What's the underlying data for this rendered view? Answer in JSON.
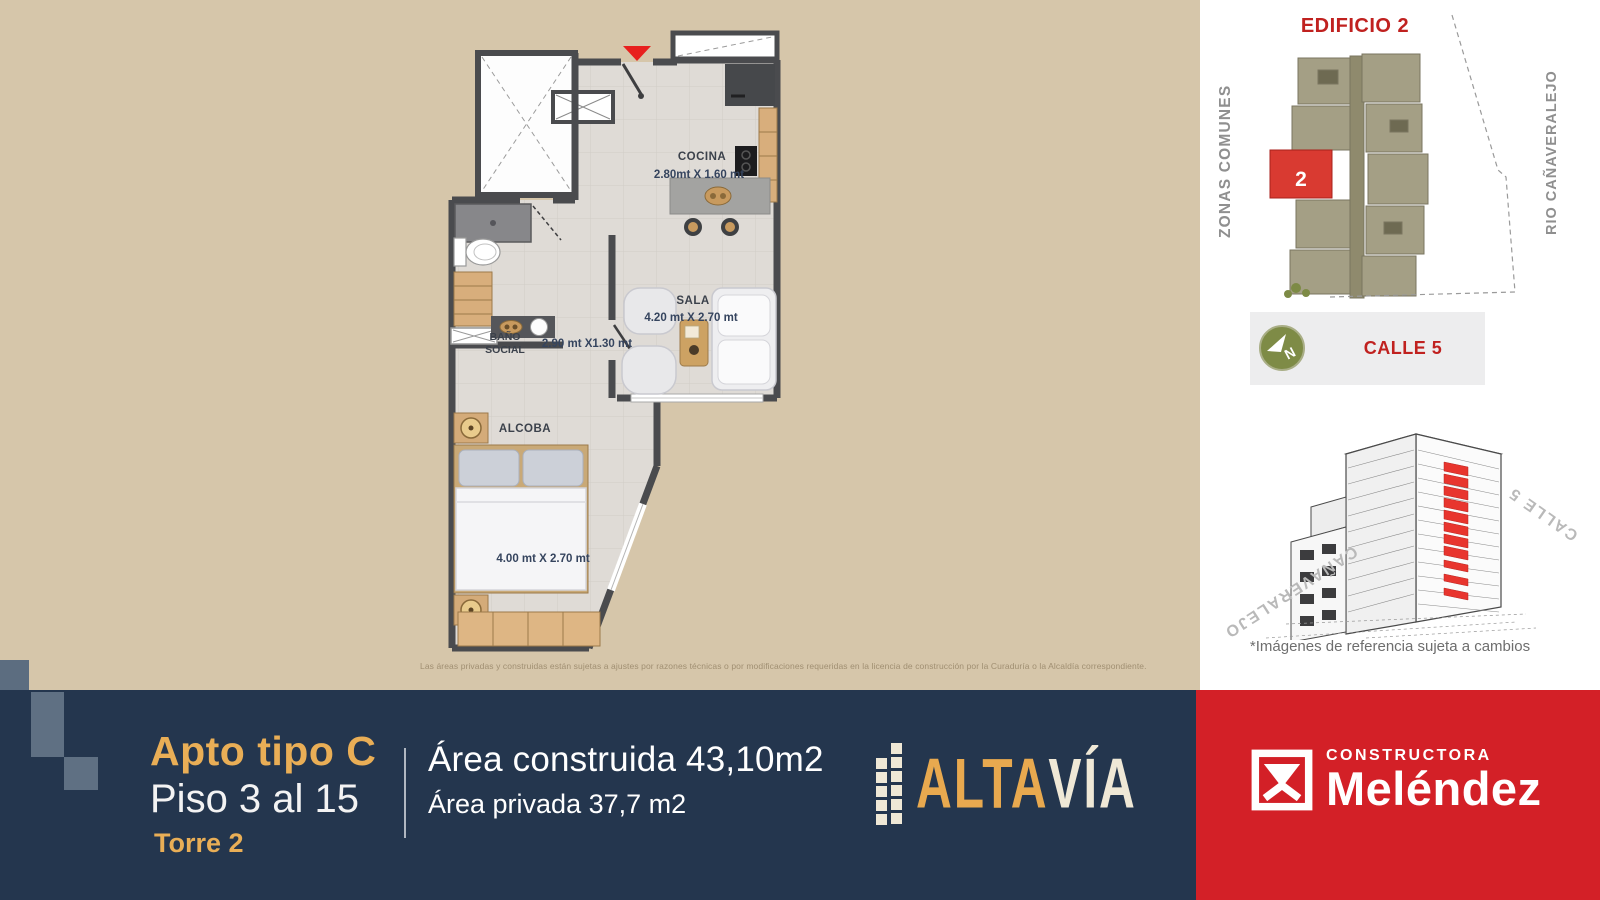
{
  "plan": {
    "rooms": {
      "cocina": {
        "name": "COCINA",
        "dims": "2.80mt X 1.60 mt"
      },
      "sala": {
        "name": "SALA",
        "dims": "4.20 mt X 2.70 mt"
      },
      "bano": {
        "line1": "BAÑO",
        "line2": "SOCIAL",
        "dims": "2.90 mt X1.30 mt"
      },
      "alcoba": {
        "name": "ALCOBA",
        "dims": "4.00 mt X 2.70 mt"
      }
    },
    "disclaimer": "Las áreas privadas y construidas están sujetas a ajustes por razones técnicas o por modificaciones requeridas en la licencia de construcción por la Curaduría o la Alcaldía correspondiente."
  },
  "sidebar": {
    "site_title": "EDIFICIO 2",
    "highlighted_unit": "2",
    "label_left": "ZONAS COMUNES",
    "label_right": "RIO CAÑAVERALEJO",
    "street": {
      "name": "CALLE 5",
      "compass_letter": "N"
    },
    "render_labels": {
      "left": "CAÑAVERALEJO",
      "right": "CALLE 5"
    },
    "caption": "*Imágenes de referencia sujeta a cambios"
  },
  "footer": {
    "apt_type": "Apto tipo C",
    "floors": "Piso 3 al 15",
    "tower": "Torre 2",
    "built_area": "Área construida 43,10m2",
    "private_area": "Área privada 37,7 m2",
    "altavia_logo": {
      "part_gold": "ALTA",
      "part_cream": "VÍA"
    },
    "melendez_logo": {
      "line1": "CONSTRUCTORA",
      "line2": "Meléndez"
    }
  },
  "colors": {
    "beige_bg": "#d6c6aa",
    "navy": "#24364e",
    "gold": "#e9ae56",
    "red_block": "#d32027",
    "site_red": "#c0211f",
    "highlight_red": "#e8352e",
    "olive_compass": "#7e8b46",
    "slate_deco": "#5f7083",
    "wall": "#4a4b4e"
  },
  "icons": {
    "entrance_marker": "▼",
    "compass": "N-arrow"
  }
}
